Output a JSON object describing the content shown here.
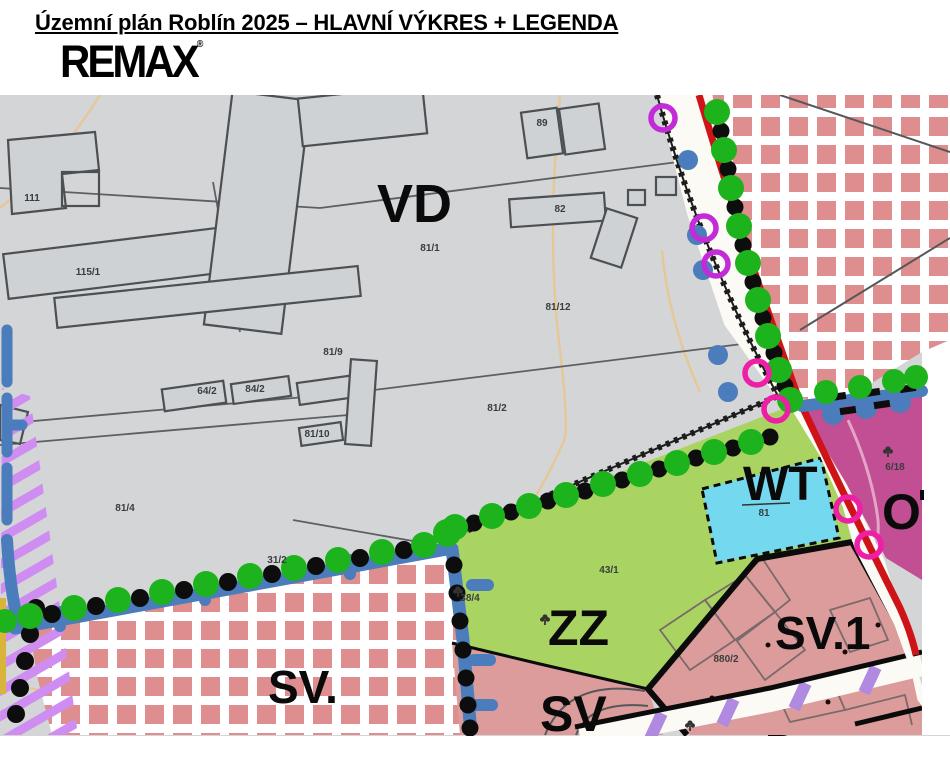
{
  "header": {
    "title": "Územní plán Roblín 2025 – HLAVNÍ VÝKRES + LEGENDA",
    "logo": "REMAX",
    "logo_mark": "®"
  },
  "map": {
    "zone_labels": {
      "vd": "VD",
      "wt": "WT",
      "zz": "ZZ",
      "sv_dot": "SV.",
      "sv": "SV",
      "sv1": "SV.1",
      "o": "O"
    },
    "parcels": [
      "111",
      "115/1",
      "89",
      "82",
      "81/1",
      "81/12",
      "81/2",
      "81/4",
      "81/9",
      "64/2",
      "84/2",
      "81/10",
      "31/2",
      "38/4",
      "43/1",
      "6/18",
      "880/2",
      "81"
    ],
    "colors": {
      "gray": "#d3d5d7",
      "building": "#cfd2d4",
      "bstroke": "#4c5054",
      "pline": "#5c6062",
      "checker": "#de8e8e",
      "zz": "#aad462",
      "wt": "#74d9ef",
      "magenta": "#c24e93",
      "pink": "#dd9c9c",
      "red": "#cf1418",
      "roadwhite": "#fbfaf4",
      "blue": "#4b7cbb",
      "gdot": "#1cb31c",
      "kdot": "#0d0d0d",
      "ring-purple": "#c32bd8",
      "ring-magenta": "#ee1fa6",
      "hatch": "#cf8df2",
      "hatch2": "#b08ae0",
      "tan": "#e6c795",
      "yellow": "#d9b43a",
      "zipper": "#1c1c1c"
    }
  }
}
